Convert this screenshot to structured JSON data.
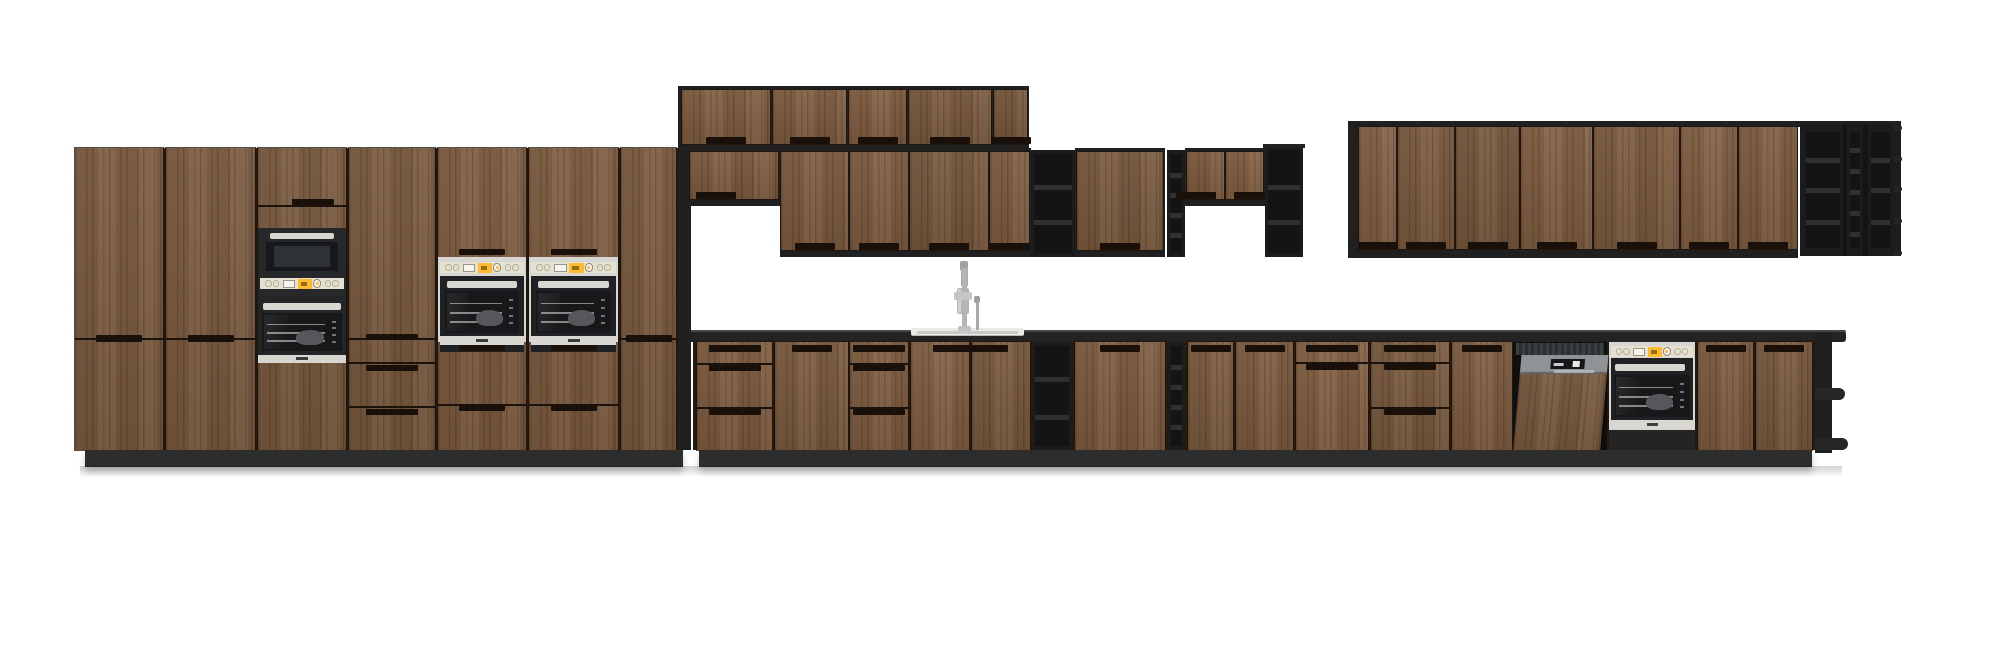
{
  "meta": {
    "description": "3D rendered elevation of a long kitchen with dark wood-grain cabinet fronts, black open shelving, stainless built-in appliances, sink with tall faucet and dark worktop",
    "background": "#ffffff"
  },
  "palette": {
    "bg": "#ffffff",
    "gapDark": "#241a10",
    "panelDark": "#202020",
    "frameDark": "#1c1c1c",
    "shelfInterior": "#141414",
    "shelfFace": "#303030",
    "lip": "#232323",
    "plinth": "#2d2d2d",
    "counter": "#232323",
    "counterEdge": "#484848",
    "steelLight": "#d7d6d1",
    "steelMid": "#b6b8ba",
    "beige": "#e5e1d2",
    "displayYellow": "#ffbb2e",
    "displayWhite": "#f5f4ef",
    "glassDark": "#17181a",
    "glassMid": "#2e3236",
    "applianceDark": "#202124",
    "recess": "#19100a",
    "line": "#1a120b",
    "rack": "rgba(225,225,228,0.55)",
    "pot": "#55575a",
    "dwFascia": "#909396",
    "dwCavity": "#0f0f0f",
    "dwDisplay": "#141618",
    "sinkRim": "#e9e9e6",
    "faucet": "#b3b5b7"
  },
  "scene": {
    "canvas": {
      "w": 2000,
      "h": 662
    },
    "sections": [
      {
        "name": "tall-cabinet-run",
        "units": [
          {
            "n": "tall-run-backing",
            "t": "rect",
            "r": [
              75,
              148,
              616,
              302
            ],
            "f": "gapDark",
            "i": false
          },
          {
            "n": "tall-door",
            "t": "tall-door",
            "r": [
              75,
              148,
              88,
              302
            ],
            "split": 339
          },
          {
            "n": "tall-door",
            "t": "tall-door",
            "r": [
              166,
              148,
              89,
              302
            ],
            "split": 339
          },
          {
            "n": "oven-microwave-tower",
            "t": "oven-tower",
            "r": [
              258,
              148,
              88,
              302
            ]
          },
          {
            "n": "tall-drawer-cabinet",
            "t": "door-drawers",
            "r": [
              349,
              148,
              86,
              302
            ],
            "splits": [
              339,
              363,
              407
            ]
          },
          {
            "n": "wall-oven-cabinet",
            "t": "oven-col",
            "r": [
              438,
              148,
              88,
              302
            ]
          },
          {
            "n": "wall-oven-cabinet",
            "t": "oven-col",
            "r": [
              529,
              148,
              89,
              302
            ]
          },
          {
            "n": "tall-door",
            "t": "tall-door",
            "r": [
              621,
              148,
              55,
              302
            ],
            "split": 339
          },
          {
            "n": "end-panel",
            "t": "rect",
            "r": [
              678,
              148,
              13,
              302
            ],
            "f": "panelDark",
            "i": false
          },
          {
            "n": "plinth",
            "t": "plinth",
            "r": [
              85,
              450,
              598,
              17
            ],
            "i": false
          }
        ]
      },
      {
        "name": "upper-cabinets-top-row",
        "units": [
          {
            "n": "top-row-backing",
            "t": "rect",
            "r": [
              678,
              86,
              351,
              66
            ],
            "f": "panelDark",
            "i": false
          },
          {
            "n": "upper-door",
            "t": "upper-door",
            "r": [
              682,
              90,
              88,
              54
            ]
          },
          {
            "n": "upper-door",
            "t": "upper-door",
            "r": [
              773,
              90,
              73,
              54
            ]
          },
          {
            "n": "upper-door",
            "t": "upper-door",
            "r": [
              849,
              90,
              57,
              54
            ]
          },
          {
            "n": "upper-door",
            "t": "upper-door",
            "r": [
              909,
              90,
              82,
              54
            ]
          },
          {
            "n": "upper-door",
            "t": "upper-door",
            "r": [
              994,
              90,
              33,
              54
            ]
          }
        ]
      },
      {
        "name": "upper-cabinets-mid-row",
        "units": [
          {
            "n": "short-cab-backing",
            "t": "rect",
            "r": [
              688,
              148,
              92,
              58
            ],
            "f": "panelDark",
            "i": false
          },
          {
            "n": "upper-short-door",
            "t": "upper-door",
            "r": [
              690,
              152,
              88,
              47
            ],
            "rx": 0.3
          },
          {
            "n": "mid-row-backing",
            "t": "rect",
            "r": [
              780,
              148,
              251,
              109
            ],
            "f": "panelDark",
            "i": false
          },
          {
            "n": "upper-door",
            "t": "upper-door",
            "r": [
              781,
              152,
              67,
              98
            ]
          },
          {
            "n": "upper-door",
            "t": "upper-door",
            "r": [
              850,
              152,
              58,
              98
            ]
          },
          {
            "n": "upper-door",
            "t": "upper-door",
            "r": [
              910,
              152,
              78,
              98
            ]
          },
          {
            "n": "upper-door",
            "t": "upper-door",
            "r": [
              990,
              152,
              39,
              98
            ]
          },
          {
            "n": "open-shelf-unit",
            "t": "shelf-col",
            "r": [
              1031,
              150,
              44,
              107
            ],
            "shelves": [
              185,
              220
            ]
          },
          {
            "n": "wide-door-backing",
            "t": "rect",
            "r": [
              1075,
              148,
              90,
              109
            ],
            "f": "panelDark",
            "i": false
          },
          {
            "n": "upper-door",
            "t": "upper-door",
            "r": [
              1077,
              152,
              86,
              98
            ]
          },
          {
            "n": "narrow-open-shelf",
            "t": "shelf-col",
            "r": [
              1167,
              150,
              18,
              107
            ],
            "shelves": [
              173,
              193,
              213,
              233
            ]
          },
          {
            "n": "short-pair-backing",
            "t": "rect",
            "r": [
              1185,
              148,
              80,
              58
            ],
            "f": "panelDark",
            "i": false
          },
          {
            "n": "upper-short-door",
            "t": "upper-door",
            "r": [
              1187,
              152,
              37,
              47
            ],
            "rx": 0.25
          },
          {
            "n": "upper-short-door",
            "t": "upper-door",
            "r": [
              1226,
              152,
              37,
              47
            ],
            "rx": 0.75
          },
          {
            "n": "open-shelf-end-unit",
            "t": "shelf-col",
            "r": [
              1265,
              146,
              38,
              111
            ],
            "shelves": [
              185,
              220
            ],
            "toplip": true
          }
        ]
      },
      {
        "name": "upper-cabinets-right-run",
        "units": [
          {
            "n": "top-lip",
            "t": "rect",
            "r": [
              1348,
              121,
              553,
              6
            ],
            "f": "panelDark",
            "i": false
          },
          {
            "n": "end-panel",
            "t": "rect",
            "r": [
              1348,
              126,
              9,
              132
            ],
            "f": "panelDark",
            "i": false
          },
          {
            "n": "right-run-backing",
            "t": "rect",
            "r": [
              1357,
              126,
              441,
              132
            ],
            "f": "panelDark",
            "i": false
          },
          {
            "n": "upper-door",
            "t": "upper-door",
            "r": [
              1359,
              127,
              37,
              122
            ]
          },
          {
            "n": "upper-door",
            "t": "upper-door",
            "r": [
              1398,
              127,
              56,
              122
            ]
          },
          {
            "n": "upper-door",
            "t": "upper-door",
            "r": [
              1456,
              127,
              63,
              122
            ]
          },
          {
            "n": "upper-door",
            "t": "upper-door",
            "r": [
              1521,
              127,
              71,
              122
            ]
          },
          {
            "n": "upper-door",
            "t": "upper-door",
            "r": [
              1594,
              127,
              85,
              122
            ]
          },
          {
            "n": "upper-door",
            "t": "upper-door",
            "r": [
              1681,
              127,
              56,
              122
            ]
          },
          {
            "n": "upper-door",
            "t": "upper-door",
            "r": [
              1739,
              127,
              58,
              122
            ]
          },
          {
            "n": "wine-rack-frame",
            "t": "rect",
            "r": [
              1800,
              124,
              101,
              132
            ],
            "f": "frameDark",
            "i": false
          },
          {
            "n": "wine-rack-column",
            "t": "shelf-col",
            "r": [
              1803,
              128,
              40,
              124
            ],
            "shelves": [
              158,
              188,
              220
            ],
            "flat": true
          },
          {
            "n": "divider",
            "t": "rect",
            "r": [
              1843,
              124,
              4,
              132
            ],
            "f": "shelfInterior",
            "i": false
          },
          {
            "n": "wine-rack-column",
            "t": "shelf-col",
            "r": [
              1847,
              128,
              16,
              124
            ],
            "shelves": [
              148,
              169,
              190,
              211,
              232
            ],
            "flat": true
          },
          {
            "n": "divider",
            "t": "rect",
            "r": [
              1863,
              124,
              5,
              132
            ],
            "f": "shelfInterior",
            "i": false
          },
          {
            "n": "wine-rack-column",
            "t": "shelf-col",
            "r": [
              1868,
              128,
              25,
              124
            ],
            "shelves": [
              158,
              188,
              220
            ],
            "flat": true,
            "lips": [
              125,
              156,
              186,
              218,
              250
            ]
          }
        ]
      },
      {
        "name": "worktop-and-sink",
        "units": [
          {
            "n": "countertop",
            "t": "counter",
            "r": [
              691,
              330,
              1155,
              12
            ],
            "i": false
          },
          {
            "n": "sink",
            "t": "sink",
            "r": [
              911,
              328,
              113,
              8
            ]
          },
          {
            "n": "faucet",
            "t": "faucet",
            "r": [
              954,
              261,
              28,
              70
            ]
          }
        ]
      },
      {
        "name": "base-cabinet-run",
        "units": [
          {
            "n": "base-run-backing",
            "t": "rect",
            "r": [
              693,
              342,
              1124,
              108
            ],
            "f": "gapDark",
            "i": false
          },
          {
            "n": "base-drawer-unit",
            "t": "drawers",
            "r": [
              697,
              342,
              75,
              108
            ],
            "splits": [
              363,
              407
            ]
          },
          {
            "n": "base-door",
            "t": "base-door",
            "r": [
              775,
              342,
              73,
              108
            ]
          },
          {
            "n": "base-drawer-unit",
            "t": "drawers",
            "r": [
              850,
              342,
              58,
              108
            ],
            "splits": [
              363,
              407
            ]
          },
          {
            "n": "sink-base-door",
            "t": "base-door",
            "r": [
              911,
              342,
              58,
              108
            ],
            "rx": 0.72
          },
          {
            "n": "sink-base-door",
            "t": "base-door",
            "r": [
              972,
              342,
              58,
              108
            ],
            "rx": 0.28
          },
          {
            "n": "open-shelf-unit",
            "t": "shelf-col",
            "r": [
              1032,
              342,
              40,
              108
            ],
            "shelves": [
              377,
              415
            ]
          },
          {
            "n": "base-door",
            "t": "base-door",
            "r": [
              1075,
              342,
              90,
              108
            ]
          },
          {
            "n": "narrow-open-shelf",
            "t": "shelf-col",
            "r": [
              1168,
              342,
              17,
              108
            ],
            "shelves": [
              365,
              385,
              405,
              425
            ]
          },
          {
            "n": "base-door",
            "t": "base-door",
            "r": [
              1188,
              342,
              45,
              108
            ]
          },
          {
            "n": "base-door",
            "t": "base-door",
            "r": [
              1236,
              342,
              57,
              108
            ]
          },
          {
            "n": "base-drawer-unit",
            "t": "drawers",
            "r": [
              1296,
              342,
              72,
              108
            ],
            "splits": [
              362
            ]
          },
          {
            "n": "base-drawer-unit",
            "t": "drawers",
            "r": [
              1371,
              342,
              78,
              108
            ],
            "splits": [
              362,
              407
            ]
          },
          {
            "n": "base-door",
            "t": "base-door",
            "r": [
              1452,
              342,
              60,
              108
            ]
          },
          {
            "n": "dishwasher",
            "t": "dishwasher",
            "r": [
              1513,
              342,
              94,
              110
            ]
          },
          {
            "n": "built-in-oven",
            "t": "base-oven",
            "r": [
              1609,
              342,
              86,
              108
            ]
          },
          {
            "n": "base-door",
            "t": "base-door",
            "r": [
              1698,
              342,
              55,
              108
            ]
          },
          {
            "n": "base-door",
            "t": "base-door",
            "r": [
              1756,
              342,
              56,
              108
            ]
          },
          {
            "n": "corner-shelf-unit",
            "t": "corner-shelves",
            "r": [
              1812,
              330,
              36,
              123
            ]
          },
          {
            "n": "plinth",
            "t": "plinth",
            "r": [
              699,
              450,
              1113,
              17
            ],
            "i": false
          }
        ]
      },
      {
        "name": "shadows",
        "units": [
          {
            "n": "floor-shadow",
            "t": "shadow",
            "r": [
              80,
              466,
              1762,
              11
            ],
            "i": false
          }
        ]
      }
    ]
  }
}
